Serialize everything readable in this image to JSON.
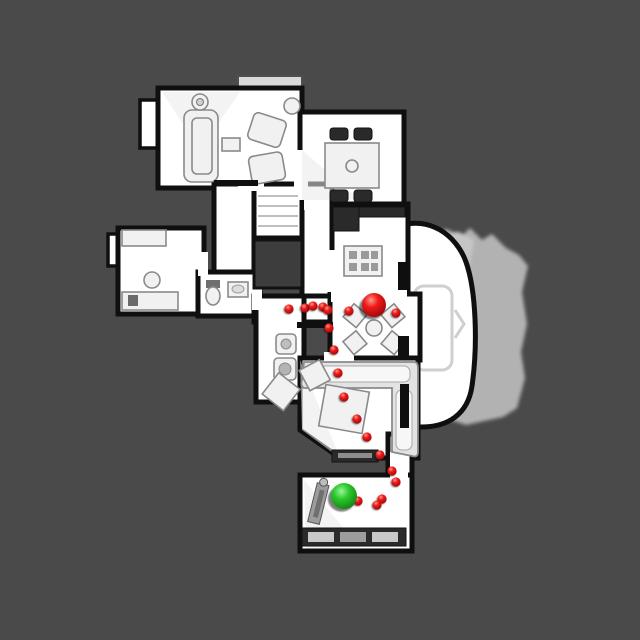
{
  "window": {
    "background_color": "#4a4a4a"
  },
  "map": {
    "floor_color": "#ffffff",
    "wall_color": "#0f0f0f",
    "unscanned_mesh_color": "#b2b2b2",
    "markers": {
      "large_red_sphere": {
        "x": 374,
        "y": 305,
        "r": 12,
        "color": "#e41414"
      },
      "green_sphere": {
        "x": 344,
        "y": 496,
        "r": 13,
        "color": "#2cc42c"
      },
      "waypoint_color": "#e41414",
      "waypoint_radius": 4.6,
      "waypoints": [
        [
          289,
          309
        ],
        [
          305,
          308
        ],
        [
          313,
          306
        ],
        [
          323,
          307
        ],
        [
          328,
          310
        ],
        [
          349,
          311
        ],
        [
          396,
          313
        ],
        [
          329,
          328
        ],
        [
          334,
          350
        ],
        [
          338,
          373
        ],
        [
          344,
          397
        ],
        [
          357,
          419
        ],
        [
          367,
          437
        ],
        [
          380,
          455
        ],
        [
          392,
          471
        ],
        [
          396,
          482
        ],
        [
          382,
          499
        ],
        [
          377,
          505
        ],
        [
          358,
          501
        ]
      ]
    }
  }
}
